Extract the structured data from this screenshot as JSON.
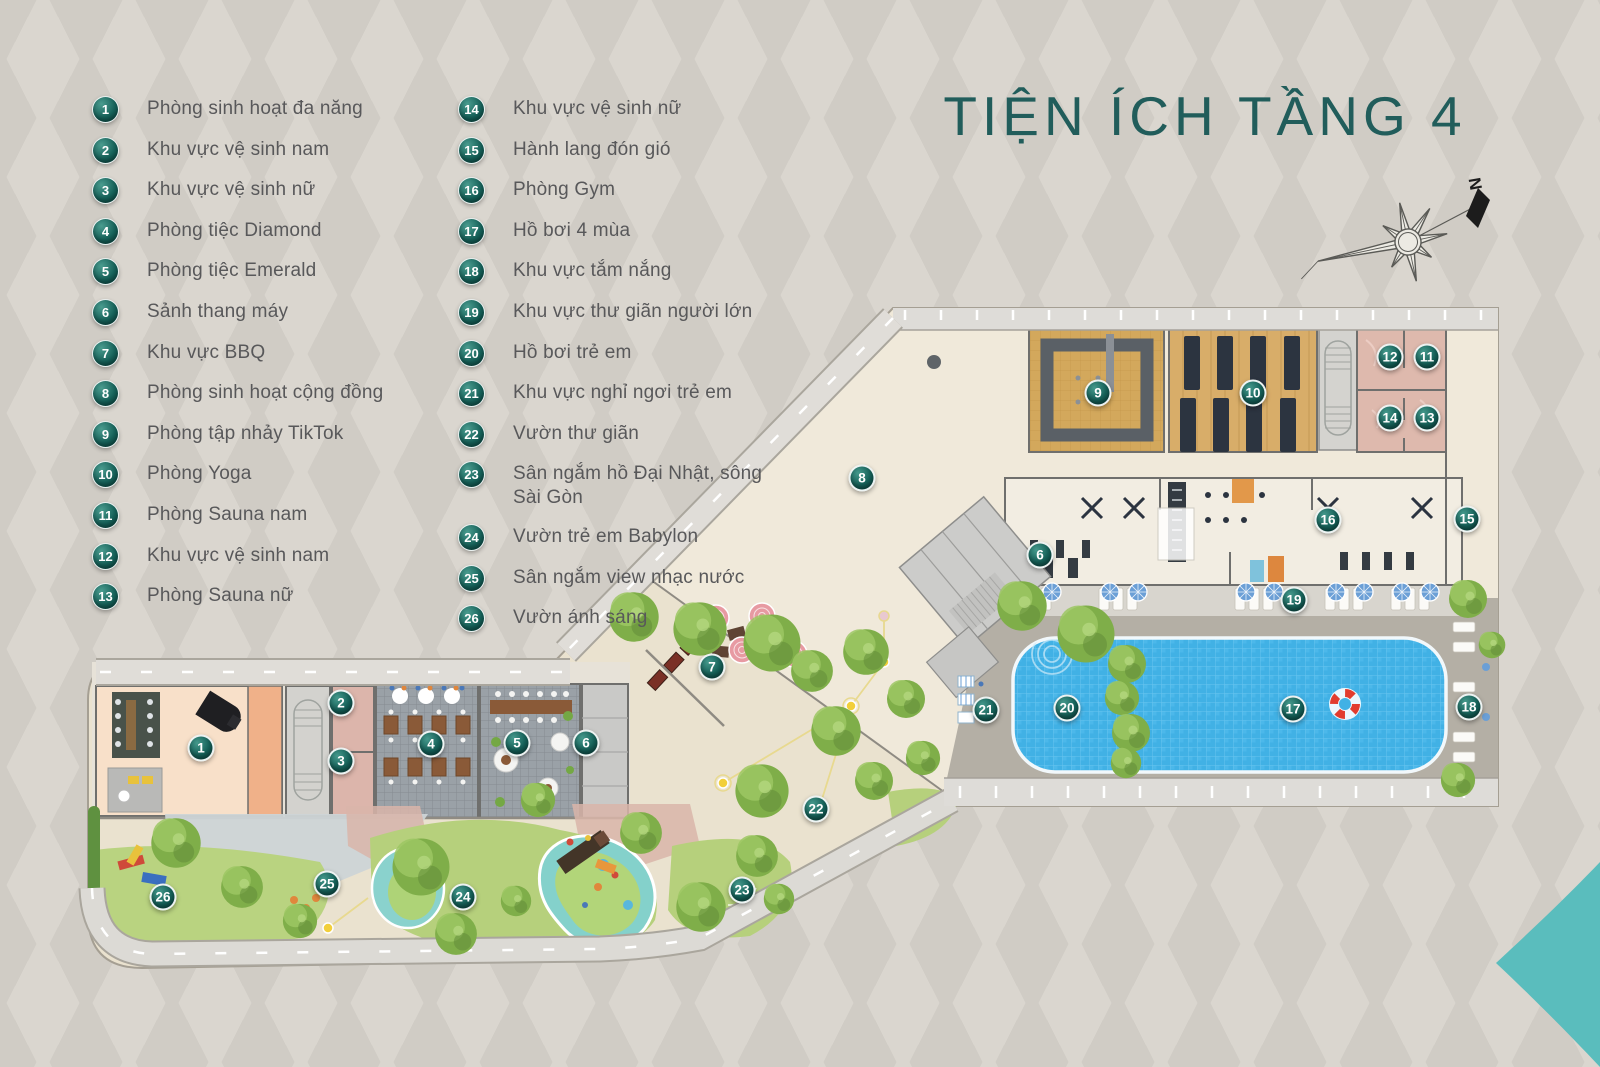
{
  "title": "TIỆN ÍCH TẦNG 4",
  "compass": {
    "label": "N"
  },
  "colors": {
    "accent_teal": "#11605a",
    "title_teal": "#215d5b",
    "pool_blue": "#41b1e5",
    "flourish_teal": "#5abdbd",
    "legend_text": "#58585a"
  },
  "legend": {
    "col1": [
      {
        "num": "1",
        "label": "Phòng sinh hoạt đa năng"
      },
      {
        "num": "2",
        "label": "Khu vực vệ sinh nam"
      },
      {
        "num": "3",
        "label": "Khu vực vệ sinh nữ"
      },
      {
        "num": "4",
        "label": "Phòng tiệc Diamond"
      },
      {
        "num": "5",
        "label": "Phòng tiệc Emerald"
      },
      {
        "num": "6",
        "label": "Sảnh thang máy"
      },
      {
        "num": "7",
        "label": "Khu vực BBQ"
      },
      {
        "num": "8",
        "label": "Phòng sinh hoạt cộng đồng"
      },
      {
        "num": "9",
        "label": "Phòng tập nhảy TikTok"
      },
      {
        "num": "10",
        "label": "Phòng Yoga"
      },
      {
        "num": "11",
        "label": "Phòng Sauna nam"
      },
      {
        "num": "12",
        "label": "Khu vực vệ sinh nam"
      },
      {
        "num": "13",
        "label": "Phòng Sauna nữ"
      }
    ],
    "col2": [
      {
        "num": "14",
        "label": "Khu vực vệ sinh nữ"
      },
      {
        "num": "15",
        "label": "Hành lang đón gió"
      },
      {
        "num": "16",
        "label": "Phòng Gym"
      },
      {
        "num": "17",
        "label": "Hồ bơi 4 mùa"
      },
      {
        "num": "18",
        "label": "Khu vực tắm nắng"
      },
      {
        "num": "19",
        "label": "Khu vực thư giãn người lớn"
      },
      {
        "num": "20",
        "label": "Hồ bơi trẻ em"
      },
      {
        "num": "21",
        "label": "Khu vực nghỉ ngơi trẻ em"
      },
      {
        "num": "22",
        "label": "Vườn thư giãn"
      },
      {
        "num": "23",
        "label": "Sân ngắm hồ Đại Nhật, sông Sài Gòn"
      },
      {
        "num": "24",
        "label": "Vườn trẻ em Babylon"
      },
      {
        "num": "25",
        "label": "Sân ngắm view nhạc nước"
      },
      {
        "num": "26",
        "label": "Vườn ánh sáng"
      }
    ]
  },
  "map_badges": [
    {
      "num": "1",
      "x": 201,
      "y": 748
    },
    {
      "num": "2",
      "x": 341,
      "y": 703
    },
    {
      "num": "3",
      "x": 341,
      "y": 761
    },
    {
      "num": "4",
      "x": 431,
      "y": 744
    },
    {
      "num": "5",
      "x": 517,
      "y": 743
    },
    {
      "num": "6",
      "x": 586,
      "y": 743
    },
    {
      "num": "6",
      "x": 1040,
      "y": 555
    },
    {
      "num": "7",
      "x": 712,
      "y": 667
    },
    {
      "num": "8",
      "x": 862,
      "y": 478
    },
    {
      "num": "9",
      "x": 1098,
      "y": 393
    },
    {
      "num": "10",
      "x": 1253,
      "y": 393
    },
    {
      "num": "11",
      "x": 1427,
      "y": 357
    },
    {
      "num": "12",
      "x": 1390,
      "y": 357
    },
    {
      "num": "13",
      "x": 1427,
      "y": 418
    },
    {
      "num": "14",
      "x": 1390,
      "y": 418
    },
    {
      "num": "15",
      "x": 1467,
      "y": 519
    },
    {
      "num": "16",
      "x": 1328,
      "y": 520
    },
    {
      "num": "17",
      "x": 1293,
      "y": 709
    },
    {
      "num": "18",
      "x": 1469,
      "y": 707
    },
    {
      "num": "19",
      "x": 1294,
      "y": 600
    },
    {
      "num": "20",
      "x": 1067,
      "y": 708
    },
    {
      "num": "21",
      "x": 986,
      "y": 710
    },
    {
      "num": "22",
      "x": 816,
      "y": 809
    },
    {
      "num": "23",
      "x": 742,
      "y": 890
    },
    {
      "num": "24",
      "x": 463,
      "y": 897
    },
    {
      "num": "25",
      "x": 327,
      "y": 884
    },
    {
      "num": "26",
      "x": 163,
      "y": 897
    }
  ]
}
